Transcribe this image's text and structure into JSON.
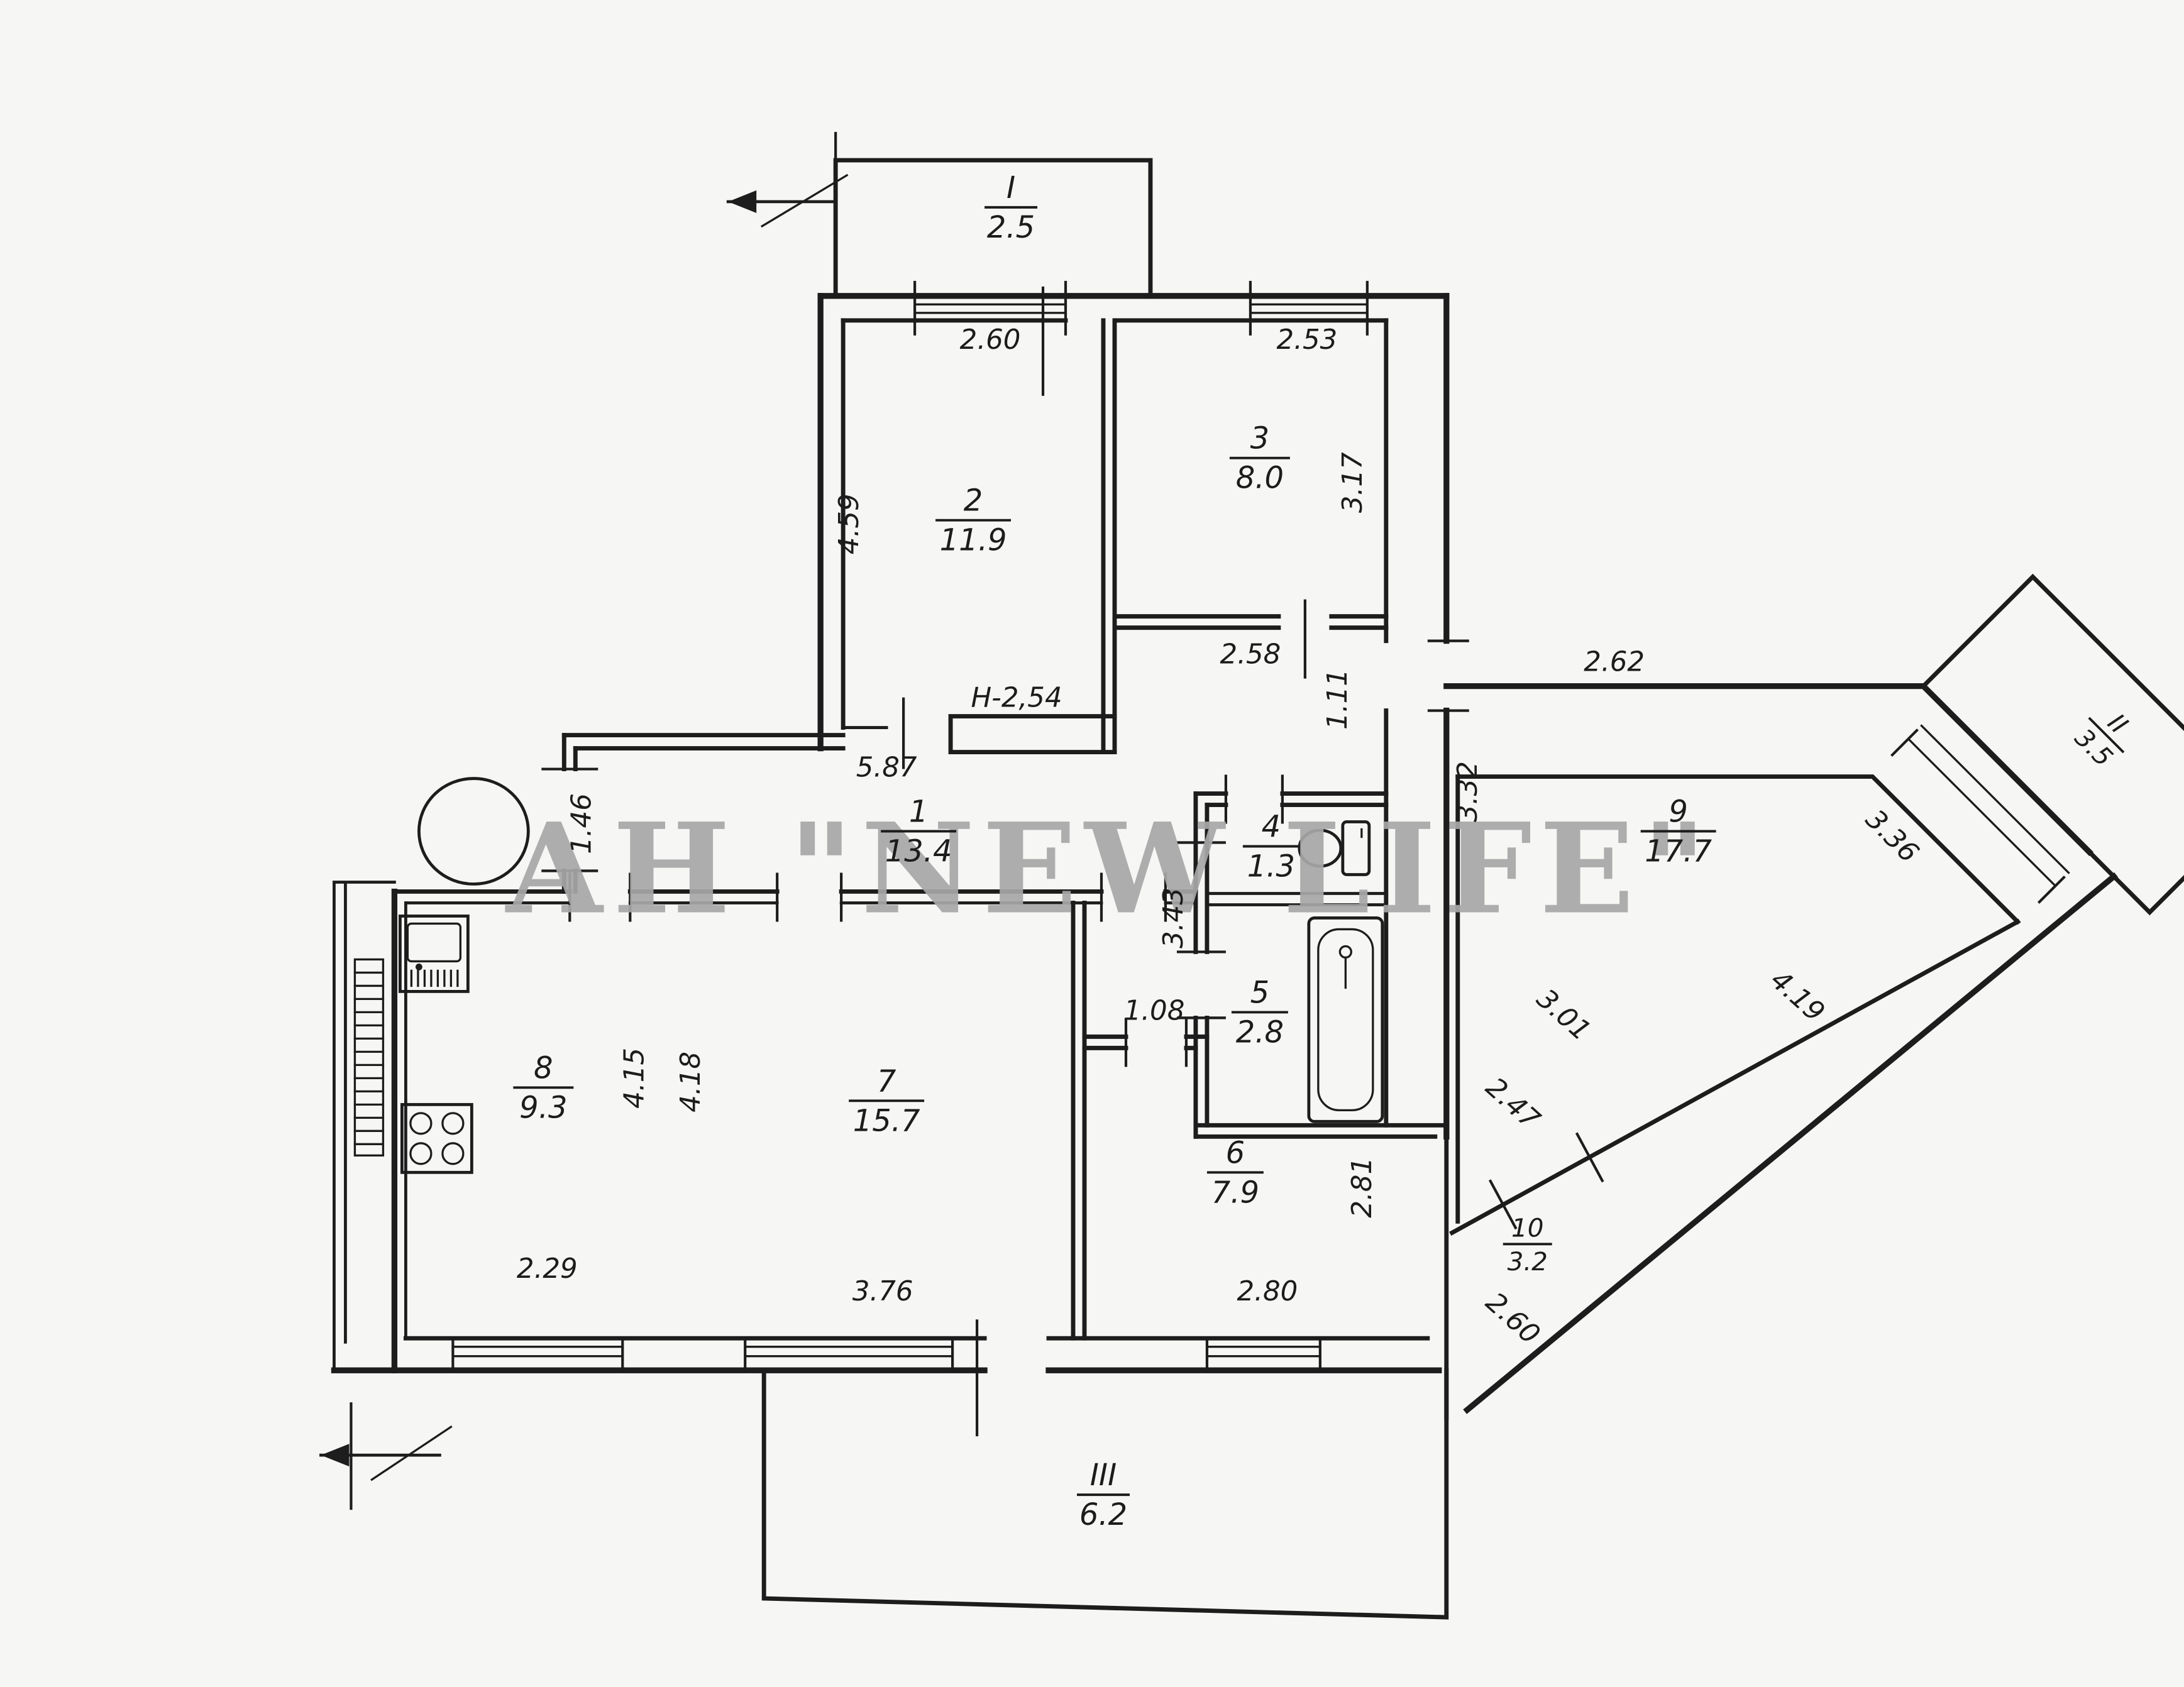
{
  "watermark": "АН \"NEW LIFE\"",
  "rooms": [
    {
      "num": "1",
      "area": "13.4"
    },
    {
      "num": "2",
      "area": "11.9"
    },
    {
      "num": "3",
      "area": "8.0"
    },
    {
      "num": "4",
      "area": "1.3"
    },
    {
      "num": "5",
      "area": "2.8"
    },
    {
      "num": "6",
      "area": "7.9"
    },
    {
      "num": "7",
      "area": "15.7"
    },
    {
      "num": "8",
      "area": "9.3"
    },
    {
      "num": "9",
      "area": "17.7"
    },
    {
      "num": "10",
      "area": "3.2"
    }
  ],
  "balconies": [
    {
      "num": "I",
      "area": "2.5"
    },
    {
      "num": "II",
      "area": "3.5"
    },
    {
      "num": "III",
      "area": "6.2"
    }
  ],
  "dims": {
    "room2_top": "2.60",
    "room3_top": "2.53",
    "room2_left": "4.59",
    "room3_right": "3.17",
    "lobby_width": "2.58",
    "passage_height": "1.11",
    "ceiling_height": "Н-2,54",
    "hall_length": "5.87",
    "hall_door": "1.46",
    "wc_bath_left": "3.43",
    "room9_top": "2.62",
    "room9_left": "3.32",
    "room9_window": "3.36",
    "room9_diagonal": "4.19",
    "loggia_seg1": "3.01",
    "loggia_seg2": "2.47",
    "loggia_seg3": "2.60",
    "room6_door": "1.08",
    "room6_right": "2.81",
    "room6_bottom": "2.80",
    "room7_bottom": "3.76",
    "kitchen_right": "4.15",
    "room7_left": "4.18",
    "kitchen_bottom": "2.29"
  }
}
